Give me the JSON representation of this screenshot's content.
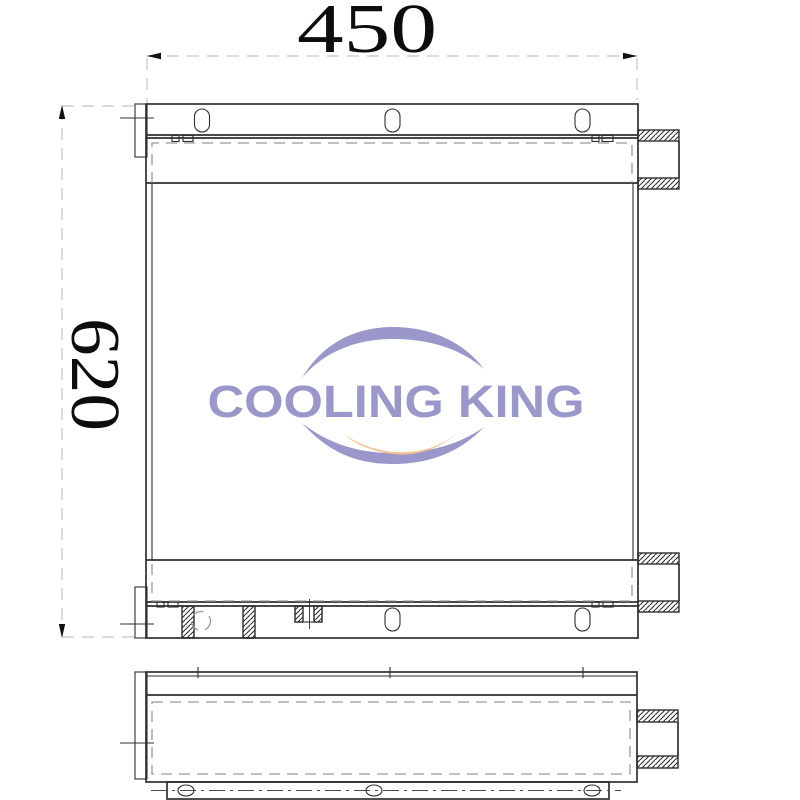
{
  "dimensions": {
    "width": {
      "value": "450"
    },
    "height": {
      "value": "620"
    }
  },
  "watermark": {
    "text": "COOLING KING",
    "primary_color": "#9a98cb",
    "accent_color": "#f6c393"
  }
}
